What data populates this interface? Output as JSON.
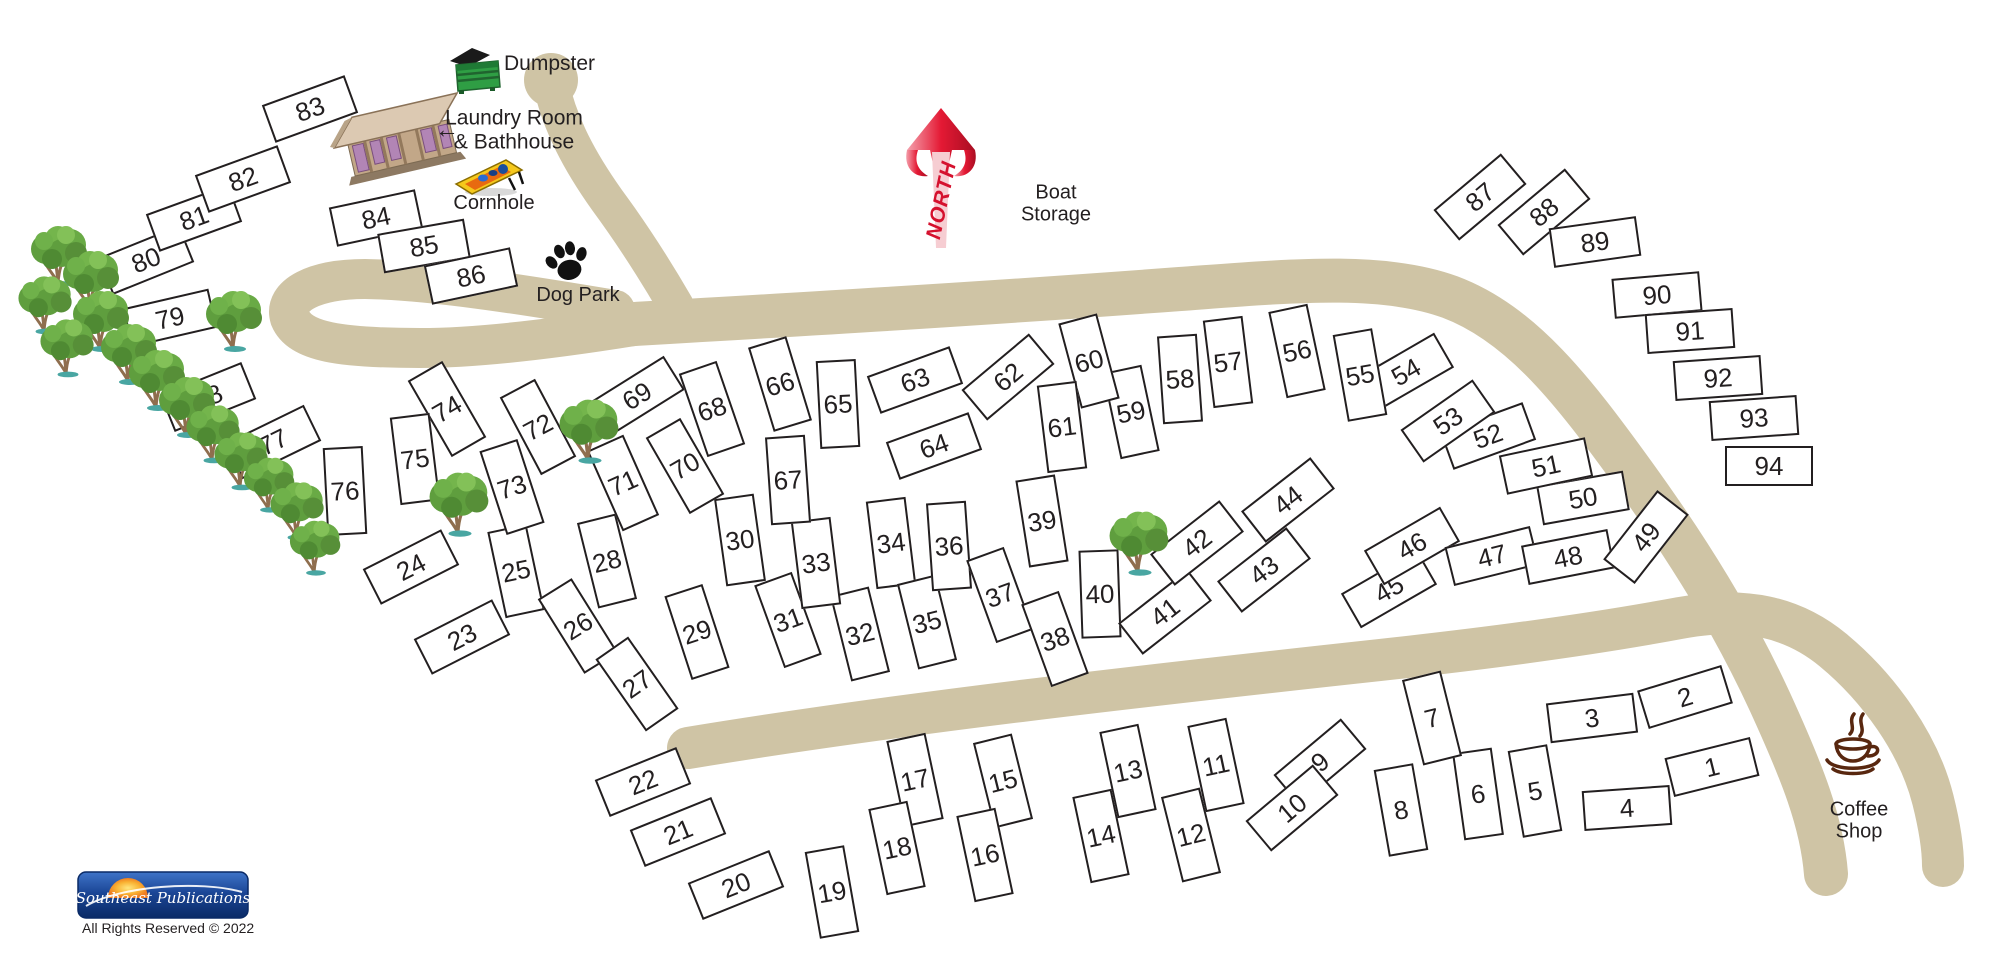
{
  "labels": {
    "dumpster": "Dumpster",
    "laundry_line1": "Laundry Room",
    "laundry_line2": "& Bathhouse",
    "laundry_arrow": "←",
    "cornhole": "Cornhole",
    "dog_park": "Dog Park",
    "north": "NORTH",
    "boat_line1": "Boat",
    "boat_line2": "Storage",
    "coffee_line1": "Coffee",
    "coffee_line2": "Shop"
  },
  "footer": {
    "logo_text": "Southeast Publications",
    "rights_text": "All Rights Reserved © 2022"
  },
  "colors": {
    "road": "#cfc4a5",
    "ink": "#231f20",
    "north": "#d5112e",
    "coffee": "#58270f",
    "tree": "#5f9e3e",
    "logoblue": "#16408f"
  },
  "sites": [
    {
      "n": 1,
      "x": 1712,
      "y": 767,
      "r": -14
    },
    {
      "n": 2,
      "x": 1685,
      "y": 697,
      "r": -17
    },
    {
      "n": 3,
      "x": 1592,
      "y": 718,
      "r": -7
    },
    {
      "n": 4,
      "x": 1627,
      "y": 808,
      "r": -4
    },
    {
      "n": 5,
      "x": 1535,
      "y": 791,
      "r": -10,
      "v": 1
    },
    {
      "n": 6,
      "x": 1478,
      "y": 794,
      "r": -8,
      "v": 1
    },
    {
      "n": 7,
      "x": 1432,
      "y": 718,
      "r": -14,
      "v": 1
    },
    {
      "n": 8,
      "x": 1401,
      "y": 810,
      "r": -10,
      "v": 1
    },
    {
      "n": 9,
      "x": 1320,
      "y": 762,
      "r": -40
    },
    {
      "n": 10,
      "x": 1292,
      "y": 808,
      "r": -40
    },
    {
      "n": 11,
      "x": 1216,
      "y": 765,
      "r": -12,
      "v": 1
    },
    {
      "n": 12,
      "x": 1191,
      "y": 835,
      "r": -14,
      "v": 1
    },
    {
      "n": 13,
      "x": 1128,
      "y": 771,
      "r": -12,
      "v": 1
    },
    {
      "n": 14,
      "x": 1101,
      "y": 836,
      "r": -12,
      "v": 1
    },
    {
      "n": 15,
      "x": 1003,
      "y": 781,
      "r": -14,
      "v": 1
    },
    {
      "n": 16,
      "x": 985,
      "y": 855,
      "r": -12,
      "v": 1
    },
    {
      "n": 17,
      "x": 915,
      "y": 780,
      "r": -12,
      "v": 1
    },
    {
      "n": 18,
      "x": 897,
      "y": 848,
      "r": -12,
      "v": 1
    },
    {
      "n": 19,
      "x": 832,
      "y": 892,
      "r": -10,
      "v": 1
    },
    {
      "n": 20,
      "x": 736,
      "y": 885,
      "r": -22
    },
    {
      "n": 21,
      "x": 678,
      "y": 832,
      "r": -22
    },
    {
      "n": 22,
      "x": 643,
      "y": 782,
      "r": -22
    },
    {
      "n": 23,
      "x": 462,
      "y": 637,
      "r": -27
    },
    {
      "n": 24,
      "x": 411,
      "y": 567,
      "r": -27
    },
    {
      "n": 25,
      "x": 516,
      "y": 571,
      "r": -12,
      "v": 1
    },
    {
      "n": 26,
      "x": 578,
      "y": 626,
      "r": -32,
      "v": 1
    },
    {
      "n": 27,
      "x": 637,
      "y": 684,
      "r": -35,
      "v": 1
    },
    {
      "n": 28,
      "x": 607,
      "y": 561,
      "r": -14,
      "v": 1
    },
    {
      "n": 29,
      "x": 697,
      "y": 632,
      "r": -18,
      "v": 1
    },
    {
      "n": 30,
      "x": 740,
      "y": 540,
      "r": -8,
      "v": 1
    },
    {
      "n": 31,
      "x": 788,
      "y": 620,
      "r": -20,
      "v": 1
    },
    {
      "n": 32,
      "x": 860,
      "y": 634,
      "r": -14,
      "v": 1
    },
    {
      "n": 33,
      "x": 816,
      "y": 563,
      "r": -7,
      "v": 1
    },
    {
      "n": 34,
      "x": 891,
      "y": 543,
      "r": -7,
      "v": 1
    },
    {
      "n": 35,
      "x": 927,
      "y": 622,
      "r": -14,
      "v": 1
    },
    {
      "n": 36,
      "x": 949,
      "y": 546,
      "r": -4,
      "v": 1
    },
    {
      "n": 37,
      "x": 1000,
      "y": 595,
      "r": -20,
      "v": 1
    },
    {
      "n": 38,
      "x": 1055,
      "y": 639,
      "r": -20,
      "v": 1
    },
    {
      "n": 39,
      "x": 1042,
      "y": 521,
      "r": -9,
      "v": 1
    },
    {
      "n": 40,
      "x": 1100,
      "y": 594,
      "r": -2,
      "v": 1
    },
    {
      "n": 41,
      "x": 1165,
      "y": 612,
      "r": -38
    },
    {
      "n": 42,
      "x": 1197,
      "y": 543,
      "r": -38
    },
    {
      "n": 43,
      "x": 1264,
      "y": 570,
      "r": -38
    },
    {
      "n": 44,
      "x": 1288,
      "y": 500,
      "r": -38
    },
    {
      "n": 45,
      "x": 1389,
      "y": 589,
      "r": -30
    },
    {
      "n": 46,
      "x": 1412,
      "y": 546,
      "r": -30
    },
    {
      "n": 47,
      "x": 1492,
      "y": 556,
      "r": -14
    },
    {
      "n": 48,
      "x": 1568,
      "y": 557,
      "r": -11
    },
    {
      "n": 49,
      "x": 1646,
      "y": 537,
      "r": -52
    },
    {
      "n": 50,
      "x": 1583,
      "y": 498,
      "r": -10
    },
    {
      "n": 51,
      "x": 1546,
      "y": 466,
      "r": -12
    },
    {
      "n": 52,
      "x": 1488,
      "y": 436,
      "r": -20
    },
    {
      "n": 53,
      "x": 1448,
      "y": 421,
      "r": -35
    },
    {
      "n": 54,
      "x": 1406,
      "y": 372,
      "r": -30
    },
    {
      "n": 55,
      "x": 1360,
      "y": 375,
      "r": -10,
      "v": 1
    },
    {
      "n": 56,
      "x": 1297,
      "y": 351,
      "r": -12,
      "v": 1
    },
    {
      "n": 57,
      "x": 1228,
      "y": 362,
      "r": -7,
      "v": 1
    },
    {
      "n": 58,
      "x": 1180,
      "y": 379,
      "r": -4,
      "v": 1
    },
    {
      "n": 59,
      "x": 1131,
      "y": 412,
      "r": -12,
      "v": 1
    },
    {
      "n": 60,
      "x": 1089,
      "y": 361,
      "r": -15,
      "v": 1
    },
    {
      "n": 61,
      "x": 1062,
      "y": 427,
      "r": -7,
      "v": 1
    },
    {
      "n": 62,
      "x": 1008,
      "y": 377,
      "r": -40
    },
    {
      "n": 63,
      "x": 915,
      "y": 380,
      "r": -20
    },
    {
      "n": 64,
      "x": 934,
      "y": 446,
      "r": -20
    },
    {
      "n": 65,
      "x": 838,
      "y": 404,
      "r": -3,
      "v": 1
    },
    {
      "n": 66,
      "x": 780,
      "y": 384,
      "r": -17,
      "v": 1
    },
    {
      "n": 67,
      "x": 788,
      "y": 480,
      "r": -4,
      "v": 1
    },
    {
      "n": 68,
      "x": 712,
      "y": 409,
      "r": -19,
      "v": 1
    },
    {
      "n": 69,
      "x": 637,
      "y": 396,
      "r": -32
    },
    {
      "n": 70,
      "x": 685,
      "y": 466,
      "r": -30,
      "v": 1
    },
    {
      "n": 71,
      "x": 623,
      "y": 483,
      "r": -24,
      "v": 1
    },
    {
      "n": 72,
      "x": 538,
      "y": 427,
      "r": -28,
      "v": 1
    },
    {
      "n": 73,
      "x": 512,
      "y": 487,
      "r": -18,
      "v": 1
    },
    {
      "n": 74,
      "x": 447,
      "y": 409,
      "r": -30,
      "v": 1
    },
    {
      "n": 75,
      "x": 415,
      "y": 459,
      "r": -7,
      "v": 1
    },
    {
      "n": 76,
      "x": 345,
      "y": 491,
      "r": -3,
      "v": 1
    },
    {
      "n": 77,
      "x": 273,
      "y": 442,
      "r": -26
    },
    {
      "n": 78,
      "x": 208,
      "y": 397,
      "r": -22
    },
    {
      "n": 79,
      "x": 170,
      "y": 318,
      "r": -13
    },
    {
      "n": 80,
      "x": 146,
      "y": 260,
      "r": -22
    },
    {
      "n": 81,
      "x": 194,
      "y": 218,
      "r": -20
    },
    {
      "n": 82,
      "x": 243,
      "y": 179,
      "r": -20
    },
    {
      "n": 83,
      "x": 310,
      "y": 109,
      "r": -20
    },
    {
      "n": 84,
      "x": 376,
      "y": 218,
      "r": -12
    },
    {
      "n": 85,
      "x": 424,
      "y": 246,
      "r": -10
    },
    {
      "n": 86,
      "x": 471,
      "y": 276,
      "r": -12
    },
    {
      "n": 87,
      "x": 1480,
      "y": 197,
      "r": -40
    },
    {
      "n": 88,
      "x": 1544,
      "y": 212,
      "r": -40
    },
    {
      "n": 89,
      "x": 1595,
      "y": 242,
      "r": -8
    },
    {
      "n": 90,
      "x": 1657,
      "y": 295,
      "r": -5
    },
    {
      "n": 91,
      "x": 1690,
      "y": 331,
      "r": -4
    },
    {
      "n": 92,
      "x": 1718,
      "y": 378,
      "r": -4
    },
    {
      "n": 93,
      "x": 1754,
      "y": 418,
      "r": -4
    },
    {
      "n": 94,
      "x": 1769,
      "y": 466,
      "r": 0
    }
  ],
  "trees": [
    {
      "x": 60,
      "y": 253,
      "s": 1
    },
    {
      "x": 92,
      "y": 278,
      "s": 1
    },
    {
      "x": 46,
      "y": 302,
      "s": 0.95
    },
    {
      "x": 102,
      "y": 318,
      "s": 1
    },
    {
      "x": 68,
      "y": 345,
      "s": 0.95
    },
    {
      "x": 130,
      "y": 351,
      "s": 1
    },
    {
      "x": 158,
      "y": 377,
      "s": 1
    },
    {
      "x": 188,
      "y": 404,
      "s": 1
    },
    {
      "x": 214,
      "y": 431,
      "s": 0.95
    },
    {
      "x": 242,
      "y": 458,
      "s": 0.95
    },
    {
      "x": 270,
      "y": 482,
      "s": 0.9
    },
    {
      "x": 298,
      "y": 508,
      "s": 0.95
    },
    {
      "x": 316,
      "y": 545,
      "s": 0.9
    },
    {
      "x": 235,
      "y": 318,
      "s": 1
    },
    {
      "x": 460,
      "y": 501,
      "s": 1.05
    },
    {
      "x": 590,
      "y": 428,
      "s": 1.05
    },
    {
      "x": 1140,
      "y": 540,
      "s": 1.05
    }
  ]
}
